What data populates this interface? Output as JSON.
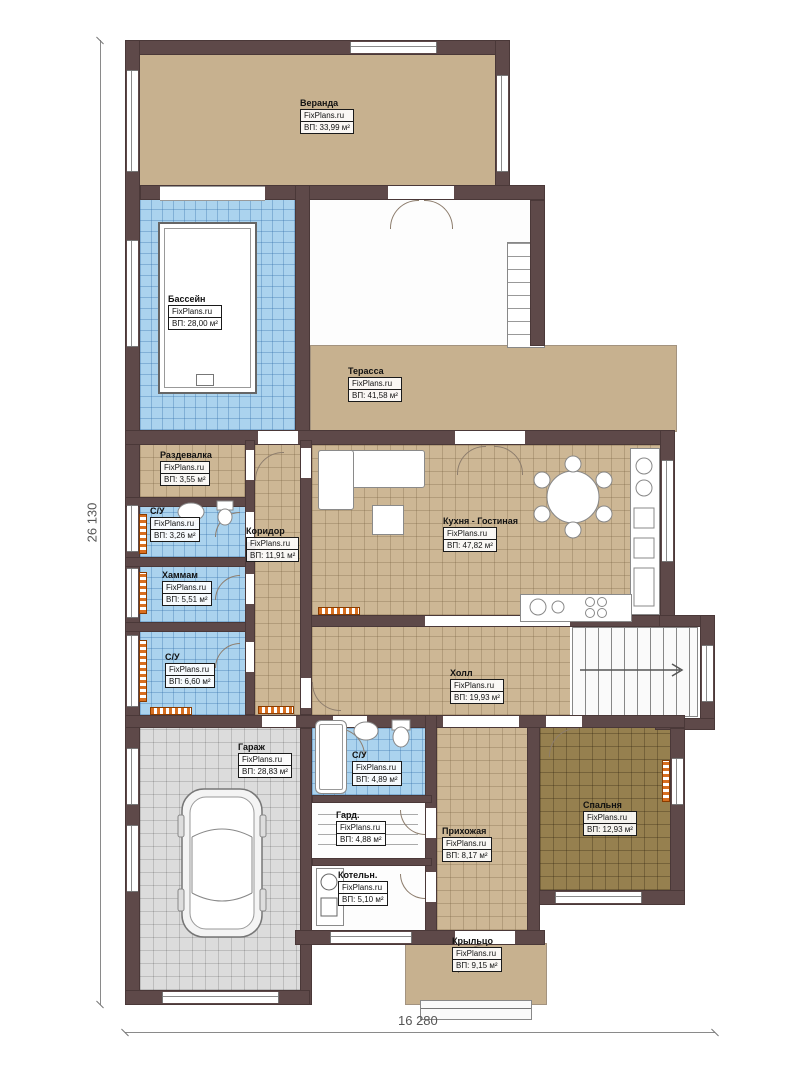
{
  "brand": "FixPlans.ru",
  "dimensions": {
    "left": "26 130",
    "bottom": "16 280"
  },
  "rooms": {
    "veranda": {
      "name": "Веранда",
      "area": "ВП: 33,99 м²"
    },
    "pool": {
      "name": "Бассейн",
      "area": "ВП: 28,00 м²"
    },
    "terrace": {
      "name": "Терасса",
      "area": "ВП: 41,58 м²"
    },
    "dressing": {
      "name": "Раздевалка",
      "area": "ВП: 3,55 м²"
    },
    "wc1": {
      "name": "С/У",
      "area": "ВП: 3,26 м²"
    },
    "corridor": {
      "name": "Коридор",
      "area": "ВП: 11,91 м²"
    },
    "hammam": {
      "name": "Хаммам",
      "area": "ВП: 5,51 м²"
    },
    "wc2": {
      "name": "С/У",
      "area": "ВП: 6,60 м²"
    },
    "kitchen_living": {
      "name": "Кухня - Гостиная",
      "area": "ВП:  47,82 м²"
    },
    "hall": {
      "name": "Холл",
      "area": "ВП: 19,93 м²"
    },
    "garage": {
      "name": "Гараж",
      "area": "ВП: 28,83 м²"
    },
    "wc3": {
      "name": "С/У",
      "area": "ВП: 4,89 м²"
    },
    "wardrobe": {
      "name": "Гард.",
      "area": "ВП: 4,88 м²"
    },
    "boiler": {
      "name": "Котельн.",
      "area": "ВП: 5,10 м²"
    },
    "entry": {
      "name": "Прихожая",
      "area": "ВП: 8,17 м²"
    },
    "bedroom": {
      "name": "Спальня",
      "area": "ВП: 12,93 м²"
    },
    "porch": {
      "name": "Крыльцо",
      "area": "ВП: 9,15 м²"
    }
  },
  "colors": {
    "wall": "#5e4949",
    "beige": "#cdb795",
    "blue": "#abd3ee",
    "gray": "#dcdcdc",
    "tan": "#96804f",
    "accent_orange": "#d96f20"
  }
}
